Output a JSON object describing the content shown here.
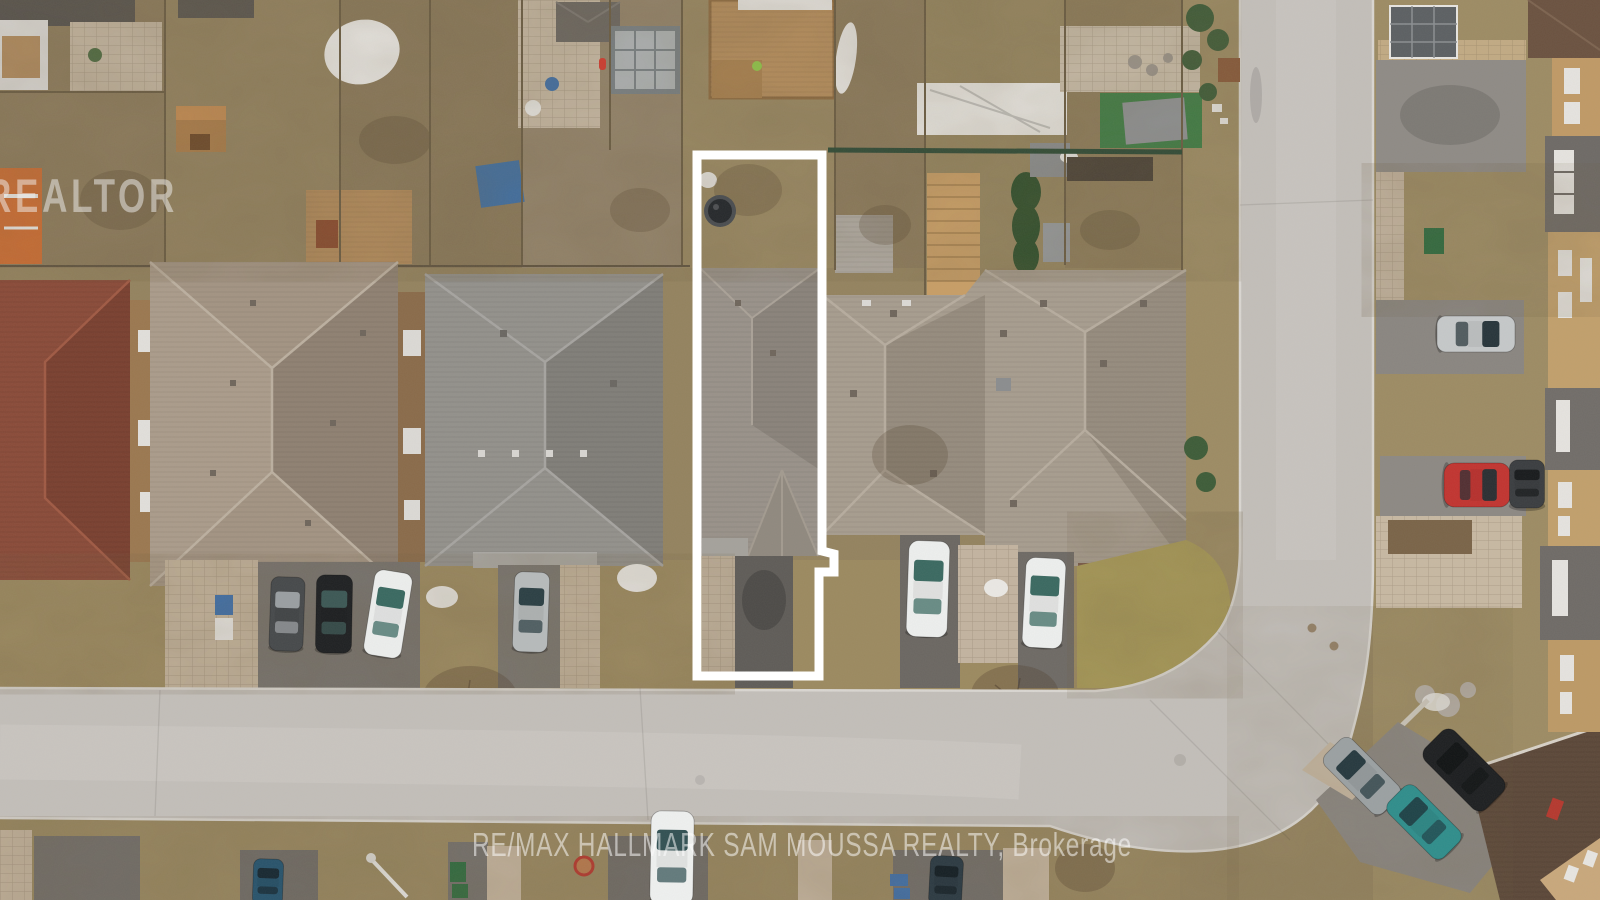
{
  "scene": {
    "type": "aerial-drone-photograph",
    "description": "Overhead drone view of a suburban residential block in early spring. A narrow subject lot in the centre is outlined in white (rear yard with hot tub, house roof, driveway). Rows of hip-roofed houses, dormant brown lawns, a light asphalt street running along the bottom that curves up into a vertical street on the right, parked cars in driveways, and real-estate watermarks."
  },
  "watermarks": {
    "realtor_logo": "REALTOR",
    "brokerage": "RE/MAX HALLMARK SAM MOUSSA REALTY, Brokerage"
  },
  "subject_lot": {
    "outline_color": "#ffffff",
    "outline_stroke_px": 9,
    "points": [
      [
        697,
        155
      ],
      [
        822,
        155
      ],
      [
        822,
        551
      ],
      [
        834,
        554
      ],
      [
        834,
        572
      ],
      [
        819,
        572
      ],
      [
        819,
        676
      ],
      [
        697,
        676
      ]
    ]
  },
  "objects": {
    "hot_tub": {
      "cx": 720,
      "cy": 211,
      "r": 16,
      "rim": "#4a4d50",
      "color": "#26292c"
    }
  },
  "cars": [
    {
      "name": "car-dark-gray-left",
      "color": "#46494b",
      "glass": "#9fa4a6",
      "x": 287,
      "y": 614,
      "w": 34,
      "h": 74,
      "r": 2
    },
    {
      "name": "car-black-left",
      "color": "#1e2022",
      "glass": "#3e5c58",
      "x": 334,
      "y": 614,
      "w": 36,
      "h": 78,
      "r": 1
    },
    {
      "name": "car-white-left",
      "color": "#edefee",
      "glass": "#2f6158",
      "x": 388,
      "y": 614,
      "w": 38,
      "h": 86,
      "r": 9
    },
    {
      "name": "car-silver-left",
      "color": "#b7bbbc",
      "glass": "#23383d",
      "x": 531,
      "y": 612,
      "w": 35,
      "h": 80,
      "r": 2
    },
    {
      "name": "car-white-center-1",
      "color": "#eef0ef",
      "glass": "#2f6158",
      "x": 928,
      "y": 589,
      "w": 41,
      "h": 96,
      "r": 2
    },
    {
      "name": "car-white-center-2",
      "color": "#eef0ef",
      "glass": "#2f6158",
      "x": 1044,
      "y": 603,
      "w": 40,
      "h": 90,
      "r": 3
    },
    {
      "name": "car-silver-right",
      "color": "#c6c9ca",
      "glass": "#1f2d33",
      "x": 1476,
      "y": 334,
      "w": 36,
      "h": 78,
      "r": 90
    },
    {
      "name": "car-red-right",
      "color": "#c23430",
      "glass": "#222e33",
      "x": 1477,
      "y": 485,
      "w": 44,
      "h": 66,
      "r": 90
    },
    {
      "name": "car-dark-suv-right",
      "color": "#3a3d40",
      "glass": "#15181a",
      "x": 1527,
      "y": 484,
      "w": 35,
      "h": 48,
      "r": 0
    },
    {
      "name": "car-gray-suv-corner",
      "color": "#9ba1a3",
      "glass": "#20343a",
      "x": 1362,
      "y": 776,
      "w": 38,
      "h": 82,
      "r": -45
    },
    {
      "name": "car-black-suv-corner",
      "color": "#1d1f21",
      "glass": "#101314",
      "x": 1464,
      "y": 770,
      "w": 42,
      "h": 86,
      "r": -45
    },
    {
      "name": "car-teal-corner",
      "color": "#2f8e8c",
      "glass": "#1d3f44",
      "x": 1424,
      "y": 822,
      "w": 38,
      "h": 78,
      "r": -45
    },
    {
      "name": "car-navy-bottom",
      "color": "#28536b",
      "glass": "#16262e",
      "x": 268,
      "y": 882,
      "w": 30,
      "h": 46,
      "r": 2
    },
    {
      "name": "car-white-suv-bottom",
      "color": "#eff1f0",
      "glass": "#26474a",
      "x": 672,
      "y": 858,
      "w": 43,
      "h": 94,
      "r": 1
    },
    {
      "name": "car-dark-bottom",
      "color": "#2c3a42",
      "glass": "#141e23",
      "x": 946,
      "y": 881,
      "w": 33,
      "h": 50,
      "r": 3
    }
  ],
  "palette": {
    "road": "#c3bfba",
    "road_light": "#cdcac5",
    "curb": "#dad7d2",
    "driveway_asphalt": "#716d68",
    "lawn_scrub": "#8f7e5e",
    "lawn_front": "#9c8a60",
    "lawn_green_hump": "#a89a58",
    "pavers": "#c6b7a1",
    "roof_taupe": "#a79d8f",
    "roof_gray": "#93918c",
    "roof_maroon": "#8a4b39",
    "roof_dark_brown": "#5c4839",
    "wall_tan": "#c09a66",
    "deck_wood": "#b68e5d",
    "snow": "#ebe9e5",
    "fence_green": "#2c4a36",
    "outline_white": "#ffffff"
  }
}
